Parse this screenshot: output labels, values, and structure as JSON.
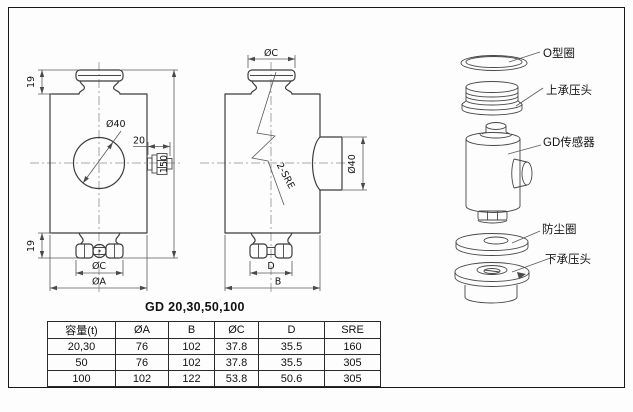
{
  "page": {
    "model_title": "GD 20,30,50,100"
  },
  "front_view": {
    "dim_top_19": "19",
    "dim_bottom_19": "19",
    "dim_height_150": "150",
    "dim_bore_d40": "Ø40",
    "dim_connector_20": "20",
    "dim_cap_dc": "ØC",
    "dim_base_da": "ØA"
  },
  "side_view": {
    "dim_cap_dc": "ØC",
    "label_2_sre": "2-SRE",
    "dim_boss_d40": "Ø40",
    "dim_d": "D",
    "dim_b": "B"
  },
  "exploded_view": {
    "label_o_ring": "O型圈",
    "label_upper_head": "上承压头",
    "label_sensor": "GD传感器",
    "label_dust_ring": "防尘圈",
    "label_lower_head": "下承压头"
  },
  "table": {
    "headers": [
      "容量(t)",
      "ØA",
      "B",
      "ØC",
      "D",
      "SRE"
    ],
    "rows": [
      [
        "20,30",
        "76",
        "102",
        "37.8",
        "35.5",
        "160"
      ],
      [
        "50",
        "76",
        "102",
        "37.8",
        "35.5",
        "305"
      ],
      [
        "100",
        "102",
        "122",
        "53.8",
        "50.6",
        "305"
      ]
    ]
  },
  "colors": {
    "line": "#3d3d3d",
    "dimension": "#5a5a5a",
    "centerline": "#8d8d8d",
    "text": "#141414",
    "border": "#181818",
    "background": "#ffffff"
  }
}
